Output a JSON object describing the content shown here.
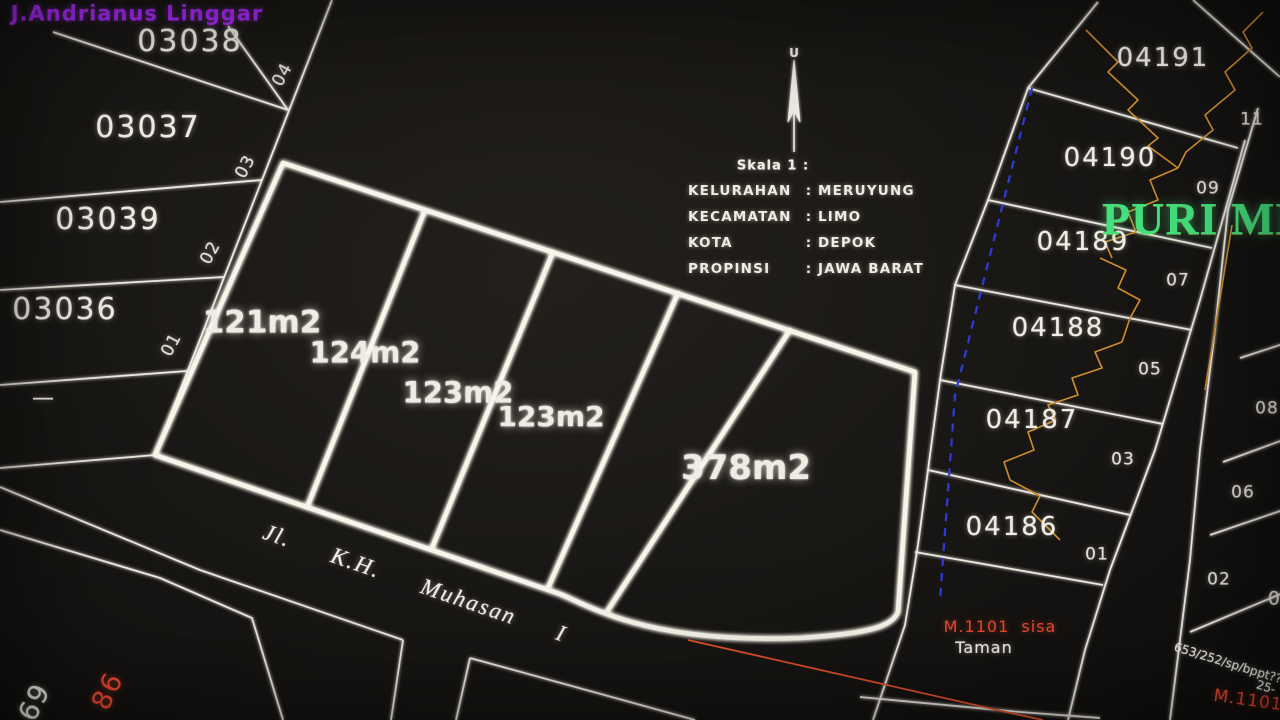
{
  "colors": {
    "line_white": "#f0ede6",
    "accent_magenta": "#a92bf5",
    "accent_green": "#43e07e",
    "accent_red": "#e53826",
    "accent_orange": "#d08d2c",
    "accent_blue": "#2e3bdc"
  },
  "overlay": {
    "owner_name": "J.Andrianus Linggar"
  },
  "north": {
    "label": "U"
  },
  "scale_label": "Skala 1 :",
  "admin": {
    "rows": [
      {
        "label": "KELURAHAN",
        "sep": ":",
        "value": "MERUYUNG"
      },
      {
        "label": "KECAMATAN",
        "sep": ":",
        "value": "LIMO"
      },
      {
        "label": "KOTA",
        "sep": ":",
        "value": "DEPOK"
      },
      {
        "label": "PROPINSI",
        "sep": ":",
        "value": "JAWA BARAT"
      }
    ]
  },
  "left_block": {
    "parcels": [
      {
        "id": "03038",
        "tag": "04"
      },
      {
        "id": "03037",
        "tag": "03"
      },
      {
        "id": "03039",
        "tag": "02"
      },
      {
        "id": "03036",
        "tag": "01"
      }
    ],
    "dash": "—"
  },
  "central_block": {
    "areas": [
      "121m2",
      "124m2",
      "123m2",
      "123m2",
      "378m2"
    ]
  },
  "street": {
    "name": "Jl.  K.H.  Muhasan  I"
  },
  "right_block": {
    "parcels": [
      {
        "id": "04191",
        "tag": "11"
      },
      {
        "id": "04190",
        "tag": "09"
      },
      {
        "id": "04189",
        "tag": "07"
      },
      {
        "id": "04188",
        "tag": "05"
      },
      {
        "id": "04187",
        "tag": "03"
      },
      {
        "id": "04186",
        "tag": "01"
      }
    ]
  },
  "east_column": {
    "tags": [
      "08",
      "06",
      "02",
      "04"
    ]
  },
  "estate_label": "PURI MERU",
  "annotations": {
    "m1101_sisa": "M.1101  sisa",
    "taman": "Taman",
    "ref_rotated": "653/252/sp/bppt??",
    "ref_number": "25-",
    "m1101": "M.1101",
    "corner_white": "69",
    "corner_red": "86"
  }
}
